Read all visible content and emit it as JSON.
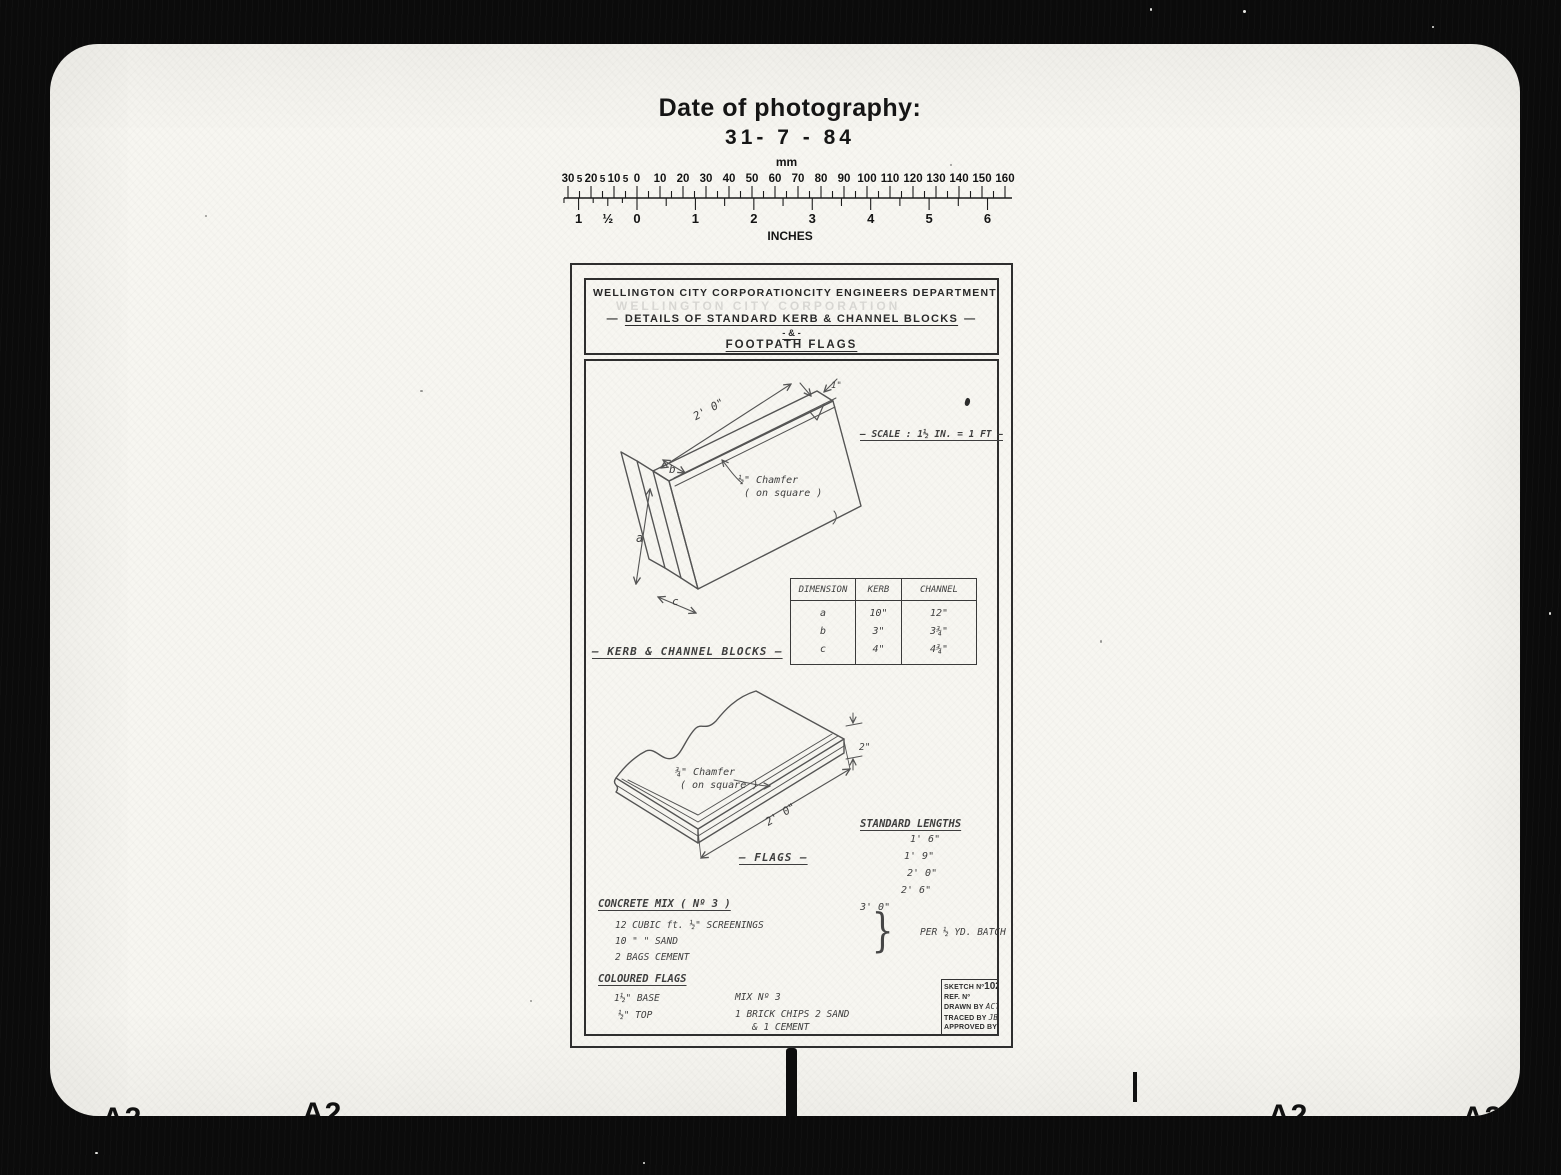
{
  "photo": {
    "header": {
      "label": "Date of photography:",
      "date": "31- 7 - 84"
    },
    "ruler": {
      "unit_top": "mm",
      "unit_bottom": "INCHES",
      "mm_labels": [
        "30",
        "5",
        "20",
        "5",
        "10",
        "5",
        "0",
        "10",
        "20",
        "30",
        "40",
        "50",
        "60",
        "70",
        "80",
        "90",
        "100",
        "110",
        "120",
        "130",
        "140",
        "150",
        "160"
      ],
      "inch_labels": [
        "1",
        "½",
        "0",
        "1",
        "2",
        "3",
        "4",
        "5",
        "6"
      ]
    },
    "film_marks": {
      "sheet_code": "A2"
    }
  },
  "drawing": {
    "title_block": {
      "org": "WELLINGTON CITY CORPORATION",
      "dept": "CITY ENGINEERS DEPARTMENT",
      "dash": "—",
      "title_main": "DETAILS OF STANDARD KERB & CHANNEL BLOCKS",
      "amp_line": "- & -",
      "title_sub": "FOOTPATH FLAGS"
    },
    "scale_note": "— SCALE : 1½ IN. = 1 FT —",
    "kerb": {
      "length_dim": "2' 0\"",
      "top_dim": "1\"",
      "dim_a": "a",
      "dim_b": "b",
      "dim_c": "c",
      "chamfer_line1": "½\" Chamfer",
      "chamfer_line2": "( on square )",
      "caption": "— KERB & CHANNEL BLOCKS —"
    },
    "dim_table": {
      "headers": [
        "DIMENSION",
        "KERB",
        "CHANNEL"
      ],
      "rows": [
        [
          "a",
          "10\"",
          "12\""
        ],
        [
          "b",
          "3\"",
          "3¾\""
        ],
        [
          "c",
          "4\"",
          "4¾\""
        ]
      ]
    },
    "flags": {
      "chamfer_line1": "¾\" Chamfer",
      "chamfer_line2": "( on square )",
      "length_dim": "2' 0\"",
      "thickness_dim": "2\"",
      "caption": "— FLAGS —"
    },
    "standard_lengths": {
      "heading": "STANDARD LENGTHS",
      "items": [
        "1' 6\"",
        "1' 9\"",
        "2' 0\"",
        "2' 6\"",
        "3' 0\""
      ]
    },
    "concrete_mix": {
      "heading": "CONCRETE MIX ( Nº 3 )",
      "line1": "12 CUBIC ft. ½\" SCREENINGS",
      "line2": "10    \"       \"     SAND",
      "line3": "2 BAGS CEMENT",
      "brace": "}",
      "batch_note": "PER ½ YD. BATCH"
    },
    "coloured_flags": {
      "heading": "COLOURED FLAGS",
      "r1c1": "1½\" BASE",
      "r1c2": "MIX Nº 3",
      "r2c1": "½\" TOP",
      "r2c2": "1 BRICK CHIPS   2 SAND",
      "r3c2": "&   1 CEMENT"
    },
    "info_box": {
      "sketch_no_label": "SKETCH Nº",
      "sketch_no": "1021",
      "ref_label": "REF. Nº",
      "drawn_label": "DRAWN BY",
      "drawn_sig": "ACT",
      "traced_label": "TRACED BY",
      "traced_sig": "JB.",
      "approved_label": "APPROVED BY"
    }
  }
}
